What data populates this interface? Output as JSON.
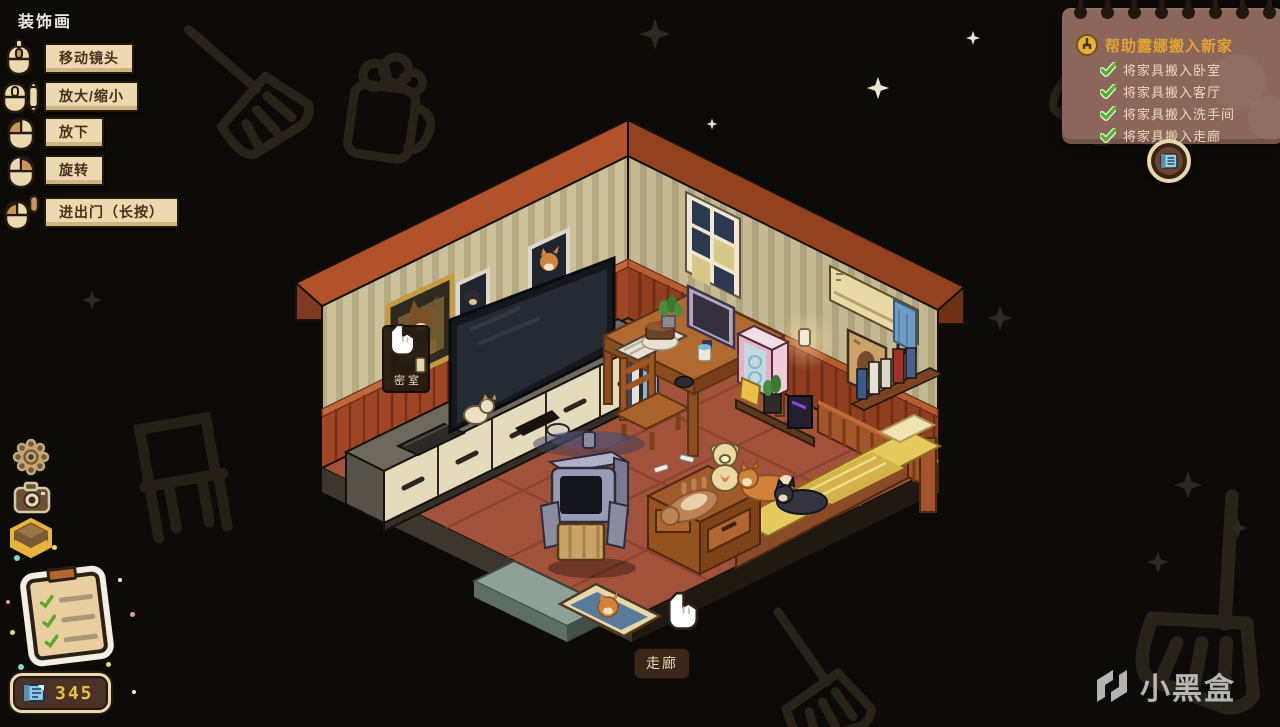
{
  "page_title": "装饰画",
  "control_hints": {
    "items": [
      {
        "icon": "mouse-middle-drag-icon",
        "label": "移动镜头"
      },
      {
        "icon": "mouse-scroll-icon",
        "label": "放大/缩小"
      },
      {
        "icon": "mouse-left-click-icon",
        "label": "放下"
      },
      {
        "icon": "mouse-right-click-icon",
        "label": "旋转"
      },
      {
        "icon": "mouse-long-press-icon",
        "label": "进出门（长按）"
      }
    ]
  },
  "quest_panel": {
    "icon": "quest-coin-icon",
    "title": "帮助露娜搬入新家",
    "tasks": [
      {
        "done": true,
        "label": "将家具搬入卧室"
      },
      {
        "done": true,
        "label": "将家具搬入客厅"
      },
      {
        "done": true,
        "label": "将家具搬入洗手间"
      },
      {
        "done": true,
        "label": "将家具搬入走廊"
      }
    ]
  },
  "toolbar": {
    "buttons": [
      {
        "icon": "settings-gear-icon"
      },
      {
        "icon": "camera-icon"
      },
      {
        "icon": "furniture-box-icon"
      },
      {
        "icon": "task-clipboard-icon"
      }
    ]
  },
  "currency": {
    "icon": "coupon-icon",
    "value": "345"
  },
  "scene": {
    "room_labels": {
      "secret_room": "密室",
      "corridor": "走廊"
    },
    "objects": [
      "tv",
      "tv-cabinet",
      "game-console",
      "laptop",
      "secret-room-painting",
      "dog-photo-frames",
      "window",
      "air-conditioner",
      "wall-lamp",
      "poster",
      "bookshelf",
      "desk",
      "monitor",
      "pc-tower",
      "keyboard",
      "desk-chair",
      "bed",
      "teddy-bear",
      "shiba-dog",
      "black-dog",
      "brown-dog",
      "robot-fan",
      "doormat",
      "door-threshold"
    ]
  },
  "watermark": {
    "logo": "heybox-logo",
    "text": "小黑盒"
  },
  "colors": {
    "background": "#0d0b08",
    "hint_ribbon_bg": "#ecd9b0",
    "hint_text": "#46301a",
    "quest_panel_bg": "#8a675a",
    "quest_title": "#e2a332",
    "quest_task_text": "#ecd9ba",
    "check_green": "#4cb32a",
    "currency_value": "#e8c23c",
    "wall": "#cdc19c",
    "wainscot": "#9e4726",
    "floor": "#a2523a",
    "bed": "#e5ca5e",
    "roof_trim": "#b2522b"
  }
}
